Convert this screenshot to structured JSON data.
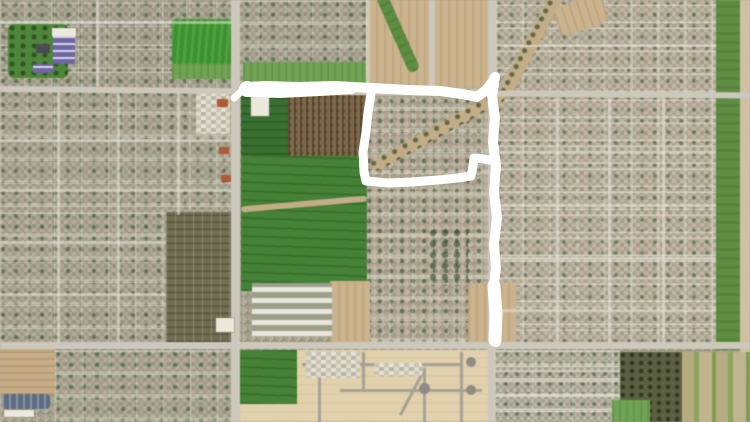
{
  "canvas": {
    "width": 750,
    "height": 422
  },
  "colors": {
    "annotation_white": "#ffffff",
    "field_green": "#3f9b2e",
    "dark_field_green": "#2f6b26",
    "residential_gray": "#a5a190",
    "road_gray": "#ccc8ba",
    "dirt_tan": "#c8af85",
    "development_beige": "#e2d1aa",
    "orchard_brown": "#826a4b",
    "canal_green": "#5d8f3f"
  },
  "map": {
    "regions": [
      {
        "name": "residential-northwest",
        "kind": "res-e",
        "x": 0,
        "y": 0,
        "w": 231,
        "h": 90
      },
      {
        "name": "residential-north-center",
        "kind": "res-a",
        "x": 231,
        "y": 0,
        "w": 140,
        "h": 88
      },
      {
        "name": "residential-northeast",
        "kind": "res-b",
        "x": 496,
        "y": 0,
        "w": 220,
        "h": 95
      },
      {
        "name": "residential-west",
        "kind": "res-a",
        "x": 0,
        "y": 90,
        "w": 231,
        "h": 122
      },
      {
        "name": "residential-southwest",
        "kind": "res-a",
        "x": 0,
        "y": 212,
        "w": 166,
        "h": 133
      },
      {
        "name": "residential-east",
        "kind": "res-b",
        "x": 496,
        "y": 95,
        "w": 220,
        "h": 250
      },
      {
        "name": "residential-inner-loop",
        "kind": "res-d",
        "x": 366,
        "y": 88,
        "w": 130,
        "h": 257
      },
      {
        "name": "residential-bottom-left",
        "kind": "res-a",
        "x": 55,
        "y": 350,
        "w": 183,
        "h": 72
      },
      {
        "name": "residential-south",
        "kind": "res-c",
        "x": 492,
        "y": 350,
        "w": 128,
        "h": 72
      },
      {
        "name": "new-development",
        "kind": "dev",
        "x": 238,
        "y": 350,
        "w": 254,
        "h": 72
      },
      {
        "name": "park-northwest",
        "kind": "park",
        "x": 8,
        "y": 24,
        "w": 60,
        "h": 54,
        "rad": "6px"
      },
      {
        "name": "sports-field",
        "kind": "field-bright",
        "x": 172,
        "y": 19,
        "w": 60,
        "h": 46,
        "rad": "4px"
      },
      {
        "name": "field-margin",
        "kind": "field-mid",
        "x": 172,
        "y": 64,
        "w": 60,
        "h": 15
      },
      {
        "name": "roadside-green-strip",
        "kind": "field-mid",
        "x": 243,
        "y": 62,
        "w": 123,
        "h": 25
      },
      {
        "name": "construction-dirt-area",
        "kind": "dirt",
        "x": 368,
        "y": 0,
        "w": 121,
        "h": 88
      },
      {
        "name": "construction-green-swale",
        "kind": "greenstrip",
        "x": 392,
        "y": -9,
        "w": 12,
        "h": 84,
        "rot": -24,
        "rad": "6px"
      },
      {
        "name": "field-dark-north",
        "kind": "field-dark",
        "x": 241,
        "y": 93,
        "w": 50,
        "h": 70
      },
      {
        "name": "orchard-field",
        "kind": "orchard-rows",
        "x": 288,
        "y": 95,
        "w": 79,
        "h": 63
      },
      {
        "name": "large-green-field",
        "kind": "field-bright2",
        "x": 241,
        "y": 156,
        "w": 126,
        "h": 135
      },
      {
        "name": "farm-track",
        "kind": "track",
        "x": 241,
        "y": 201,
        "w": 126,
        "h": 6,
        "rot": -5
      },
      {
        "name": "field-building",
        "kind": "bldg-white",
        "x": 251,
        "y": 97,
        "w": 18,
        "h": 19,
        "z": 4
      },
      {
        "name": "orchard-southwest",
        "kind": "orchard-grid",
        "x": 166,
        "y": 212,
        "w": 67,
        "h": 130
      },
      {
        "name": "greenhouse-complex",
        "kind": "greenhouse",
        "x": 252,
        "y": 283,
        "w": 80,
        "h": 53,
        "z": 2
      },
      {
        "name": "bare-dirt-lot",
        "kind": "dirt",
        "x": 330,
        "y": 281,
        "w": 40,
        "h": 62
      },
      {
        "name": "dirt-at-line-end",
        "kind": "dirt",
        "x": 468,
        "y": 284,
        "w": 48,
        "h": 60
      },
      {
        "name": "creek-wash-north",
        "kind": "creek",
        "x": 524,
        "y": -13,
        "w": 14,
        "h": 116,
        "rot": 28
      },
      {
        "name": "creek-wash-channel",
        "kind": "creek",
        "x": 362,
        "y": 125,
        "w": 152,
        "h": 12,
        "rot": -29
      },
      {
        "name": "wash-north-patch",
        "kind": "dirt",
        "x": 556,
        "y": 0,
        "w": 50,
        "h": 30,
        "rot": -18,
        "rad": "8px"
      },
      {
        "name": "tree-cluster-south",
        "kind": "trees",
        "x": 428,
        "y": 228,
        "w": 40,
        "h": 58
      },
      {
        "name": "canal-greenbelt",
        "kind": "greenstrip",
        "x": 716,
        "y": 0,
        "w": 24,
        "h": 350
      },
      {
        "name": "canal-access-road",
        "kind": "dirt-light",
        "x": 740,
        "y": 0,
        "w": 10,
        "h": 422
      },
      {
        "name": "plowed-field",
        "kind": "dirt-furrow",
        "x": 0,
        "y": 348,
        "w": 55,
        "h": 47
      },
      {
        "name": "commercial-warehouse",
        "kind": "bldg-blue",
        "x": 2,
        "y": 394,
        "w": 48,
        "h": 15,
        "z": 4
      },
      {
        "name": "warehouse-roof-strip",
        "kind": "bldg-white",
        "x": 4,
        "y": 410,
        "w": 30,
        "h": 7,
        "z": 4
      },
      {
        "name": "green-lot-south",
        "kind": "field-bright2",
        "x": 240,
        "y": 350,
        "w": 57,
        "h": 54,
        "z": 2
      },
      {
        "name": "orchard-south",
        "kind": "orchard-dark",
        "x": 620,
        "y": 352,
        "w": 62,
        "h": 70
      },
      {
        "name": "farm-strips-southeast",
        "kind": "strips",
        "x": 682,
        "y": 352,
        "w": 68,
        "h": 70
      },
      {
        "name": "green-lot-southeast",
        "kind": "field-mid",
        "x": 612,
        "y": 400,
        "w": 38,
        "h": 22,
        "z": 2
      },
      {
        "name": "shopping-plaza",
        "kind": "commercial",
        "x": 196,
        "y": 92,
        "w": 34,
        "h": 42,
        "z": 2
      },
      {
        "name": "red-roof-building-1",
        "kind": "bldg-orange",
        "x": 217,
        "y": 99,
        "w": 11,
        "h": 8,
        "z": 4
      },
      {
        "name": "red-roof-building-2",
        "kind": "bldg-orange",
        "x": 219,
        "y": 147,
        "w": 10,
        "h": 7,
        "z": 4
      },
      {
        "name": "red-roof-building-3",
        "kind": "bldg-orange",
        "x": 221,
        "y": 175,
        "w": 10,
        "h": 7,
        "z": 4
      },
      {
        "name": "school-white-roof",
        "kind": "bldg-white",
        "x": 52,
        "y": 28,
        "w": 24,
        "h": 8,
        "z": 4
      },
      {
        "name": "school-buildings",
        "kind": "bldg-purple",
        "x": 53,
        "y": 36,
        "w": 22,
        "h": 28,
        "z": 4
      },
      {
        "name": "school-building-south",
        "kind": "bldg-purple",
        "x": 33,
        "y": 64,
        "w": 20,
        "h": 9,
        "z": 4
      },
      {
        "name": "dark-roof-building",
        "kind": "bldg-dark",
        "x": 36,
        "y": 44,
        "w": 14,
        "h": 9,
        "z": 4
      },
      {
        "name": "warehouse-building",
        "kind": "bldg-white",
        "x": 216,
        "y": 318,
        "w": 18,
        "h": 14,
        "z": 4
      },
      {
        "name": "road-main-horizontal-north",
        "kind": "road-h",
        "x": 0,
        "y": 86,
        "w": 750,
        "h": 6,
        "rot": 0.5,
        "z": 3
      },
      {
        "name": "road-main-horizontal-south",
        "kind": "road-h",
        "x": 0,
        "y": 342,
        "w": 750,
        "h": 7,
        "z": 3
      },
      {
        "name": "road-main-vertical-west",
        "kind": "road-v",
        "x": 231,
        "y": 0,
        "w": 9,
        "h": 422,
        "z": 3
      },
      {
        "name": "road-main-vertical-east",
        "kind": "road-v",
        "x": 488,
        "y": 0,
        "w": 8,
        "h": 422,
        "z": 3
      },
      {
        "name": "road-construction",
        "kind": "road-v",
        "x": 429,
        "y": 0,
        "w": 6,
        "h": 88,
        "z": 3
      },
      {
        "name": "road-field-edge",
        "kind": "road-minor",
        "x": 366,
        "y": 0,
        "w": 4,
        "h": 88,
        "z": 2
      },
      {
        "name": "street-west-v1",
        "kind": "road-minor",
        "x": 57,
        "y": 93,
        "w": 3,
        "h": 250,
        "z": 2
      },
      {
        "name": "street-west-v2",
        "kind": "road-minor",
        "x": 117,
        "y": 93,
        "w": 3,
        "h": 250,
        "z": 2
      },
      {
        "name": "street-west-v3",
        "kind": "road-minor",
        "x": 177,
        "y": 93,
        "w": 3,
        "h": 122,
        "z": 2
      },
      {
        "name": "street-west-h1",
        "kind": "road-minor",
        "x": 0,
        "y": 139,
        "w": 231,
        "h": 3,
        "z": 2
      },
      {
        "name": "street-west-h2",
        "kind": "road-minor",
        "x": 0,
        "y": 189,
        "w": 231,
        "h": 3,
        "z": 2
      },
      {
        "name": "street-west-h3",
        "kind": "road-minor",
        "x": 0,
        "y": 241,
        "w": 166,
        "h": 3,
        "z": 2
      },
      {
        "name": "street-west-h4",
        "kind": "road-minor",
        "x": 0,
        "y": 293,
        "w": 166,
        "h": 3,
        "z": 2
      },
      {
        "name": "street-northwest-v",
        "kind": "road-minor",
        "x": 96,
        "y": 0,
        "w": 3,
        "h": 86,
        "z": 2
      },
      {
        "name": "street-northwest-h",
        "kind": "road-minor",
        "x": 0,
        "y": 21,
        "w": 231,
        "h": 3,
        "z": 2
      },
      {
        "name": "street-east-v1",
        "kind": "road-minor",
        "x": 556,
        "y": 98,
        "w": 3,
        "h": 247,
        "z": 2
      },
      {
        "name": "street-east-v2",
        "kind": "road-minor",
        "x": 608,
        "y": 98,
        "w": 3,
        "h": 247,
        "z": 2
      },
      {
        "name": "street-east-v3",
        "kind": "road-minor",
        "x": 662,
        "y": 98,
        "w": 3,
        "h": 247,
        "z": 2
      },
      {
        "name": "street-east-h1",
        "kind": "road-minor",
        "x": 496,
        "y": 151,
        "w": 220,
        "h": 3,
        "z": 2
      },
      {
        "name": "street-east-h2",
        "kind": "road-minor",
        "x": 496,
        "y": 204,
        "w": 220,
        "h": 3,
        "z": 2
      },
      {
        "name": "street-east-h3",
        "kind": "road-minor",
        "x": 496,
        "y": 257,
        "w": 220,
        "h": 3,
        "z": 2
      },
      {
        "name": "street-east-h4",
        "kind": "road-minor",
        "x": 496,
        "y": 309,
        "w": 220,
        "h": 3,
        "z": 2
      },
      {
        "name": "street-northeast-h",
        "kind": "road-minor",
        "x": 500,
        "y": 45,
        "w": 216,
        "h": 2,
        "z": 2
      },
      {
        "name": "street-southeast-h1",
        "kind": "road-minor",
        "x": 492,
        "y": 370,
        "w": 128,
        "h": 2,
        "z": 2
      },
      {
        "name": "street-southeast-h2",
        "kind": "road-minor",
        "x": 492,
        "y": 394,
        "w": 128,
        "h": 2,
        "z": 2
      },
      {
        "name": "dev-road-h1",
        "kind": "road-dev",
        "x": 302,
        "y": 363,
        "w": 158,
        "h": 3,
        "z": 3
      },
      {
        "name": "dev-road-h2",
        "kind": "road-dev",
        "x": 340,
        "y": 389,
        "w": 142,
        "h": 3,
        "z": 3
      },
      {
        "name": "dev-road-v1",
        "kind": "road-dev",
        "x": 318,
        "y": 352,
        "w": 3,
        "h": 70,
        "z": 3
      },
      {
        "name": "dev-road-v2",
        "kind": "road-dev",
        "x": 362,
        "y": 352,
        "w": 3,
        "h": 38,
        "z": 3
      },
      {
        "name": "dev-road-v3",
        "kind": "road-dev",
        "x": 423,
        "y": 368,
        "w": 3,
        "h": 54,
        "z": 3
      },
      {
        "name": "dev-road-v4",
        "kind": "road-dev",
        "x": 460,
        "y": 352,
        "w": 3,
        "h": 70,
        "z": 3
      },
      {
        "name": "dev-road-diagonal",
        "kind": "road-dev",
        "x": 410,
        "y": 370,
        "w": 3,
        "h": 48,
        "rot": 28,
        "z": 3
      },
      {
        "name": "dev-culdesac-1",
        "kind": "culdesac",
        "x": 466,
        "y": 357,
        "w": 10,
        "h": 10,
        "z": 3
      },
      {
        "name": "dev-culdesac-2",
        "kind": "culdesac",
        "x": 419,
        "y": 383,
        "w": 11,
        "h": 11,
        "z": 3
      },
      {
        "name": "dev-culdesac-3",
        "kind": "culdesac",
        "x": 466,
        "y": 385,
        "w": 10,
        "h": 10,
        "z": 3
      },
      {
        "name": "dev-model-homes",
        "kind": "commercial",
        "x": 306,
        "y": 352,
        "w": 54,
        "h": 26,
        "z": 4
      },
      {
        "name": "dev-rv-lot",
        "kind": "commercial",
        "x": 374,
        "y": 363,
        "w": 48,
        "h": 13,
        "z": 4
      }
    ]
  },
  "annotation": {
    "color": "#ffffff",
    "tool": "freehand-marker",
    "strokes": [
      {
        "name": "start-blob",
        "type": "dot",
        "cx": 247,
        "cy": 89,
        "r": 8
      },
      {
        "name": "start-tail",
        "type": "polyline",
        "width": 7,
        "points": [
          [
            234,
            98
          ],
          [
            243,
            90
          ]
        ]
      },
      {
        "name": "top-line",
        "type": "polyline",
        "width": 10,
        "points": [
          [
            246,
            87
          ],
          [
            266,
            86
          ],
          [
            298,
            87
          ],
          [
            335,
            86
          ],
          [
            372,
            88
          ],
          [
            408,
            90
          ],
          [
            440,
            91
          ],
          [
            462,
            94
          ],
          [
            477,
            97
          ],
          [
            487,
            89
          ],
          [
            493,
            81
          ],
          [
            495,
            77
          ]
        ]
      },
      {
        "name": "top-line-second-pass",
        "type": "polyline",
        "width": 8,
        "points": [
          [
            247,
            93
          ],
          [
            280,
            94
          ],
          [
            320,
            92
          ],
          [
            352,
            90
          ]
        ]
      },
      {
        "name": "east-line",
        "type": "polyline",
        "width": 10,
        "points": [
          [
            495,
            77
          ],
          [
            492,
            96
          ],
          [
            495,
            118
          ],
          [
            493,
            142
          ],
          [
            496,
            166
          ],
          [
            494,
            192
          ],
          [
            497,
            218
          ],
          [
            494,
            244
          ],
          [
            496,
            268
          ],
          [
            493,
            292
          ],
          [
            497,
            316
          ],
          [
            495,
            332
          ],
          [
            496,
            342
          ]
        ]
      },
      {
        "name": "east-line-thick-end",
        "type": "polyline",
        "width": 13,
        "points": [
          [
            494,
            286
          ],
          [
            496,
            314
          ],
          [
            495,
            340
          ]
        ]
      },
      {
        "name": "inner-loop",
        "type": "polyline",
        "width": 9,
        "points": [
          [
            371,
            94
          ],
          [
            368,
            112
          ],
          [
            366,
            132
          ],
          [
            363,
            152
          ],
          [
            364,
            172
          ],
          [
            366,
            181
          ],
          [
            388,
            183
          ],
          [
            412,
            182
          ],
          [
            438,
            180
          ],
          [
            458,
            178
          ],
          [
            471,
            176
          ],
          [
            473,
            166
          ],
          [
            474,
            158
          ],
          [
            484,
            159
          ],
          [
            494,
            161
          ]
        ]
      }
    ]
  }
}
